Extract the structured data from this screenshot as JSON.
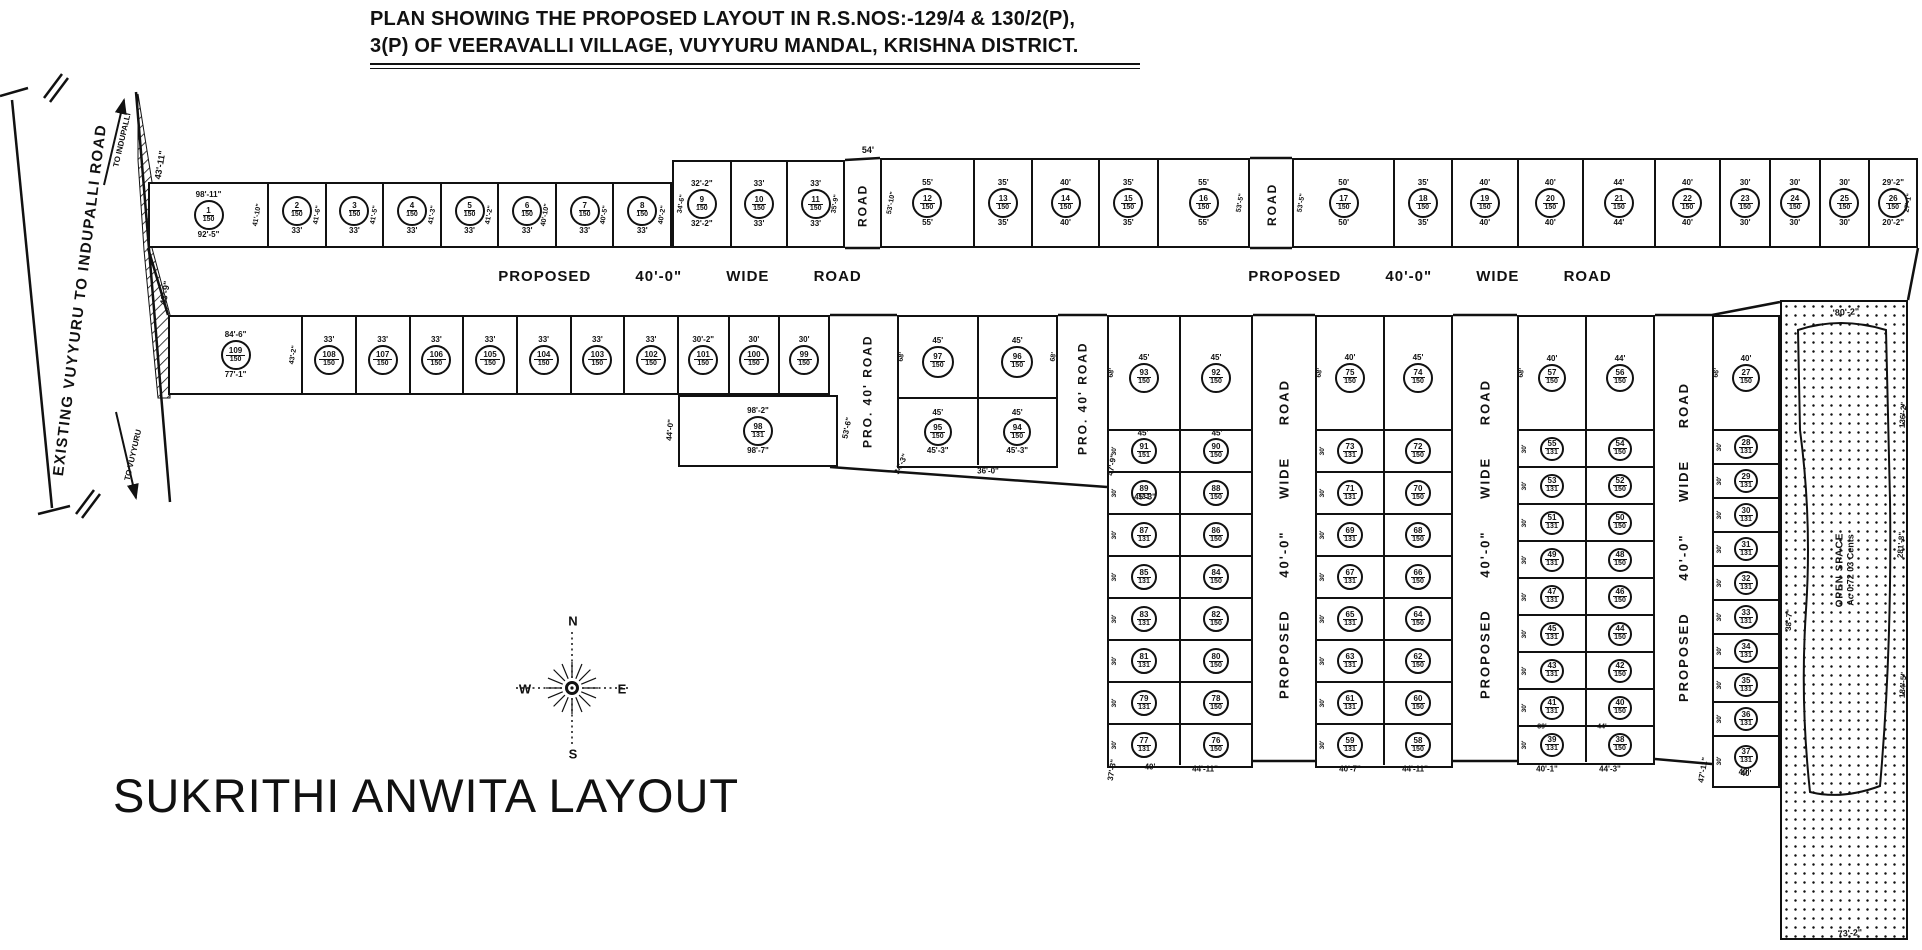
{
  "title": {
    "line1": "PLAN SHOWING THE PROPOSED LAYOUT IN R.S.NOS:-129/4 & 130/2(P),",
    "line2": "3(P) OF VEERAVALLI VILLAGE, VUYYURU MANDAL, KRISHNA DISTRICT."
  },
  "layout_name": "SUKRITHI ANWITA LAYOUT",
  "compass": {
    "n": "N",
    "s": "S",
    "e": "E",
    "w": "W"
  },
  "existing_road": {
    "name": "EXISTING VUYYURU TO INDUPALLI ROAD",
    "to_top": "TO INDUPALLI",
    "to_bottom": "TO VUYYURU"
  },
  "open_space": {
    "line1": "OPEN SPACE",
    "line2": "Ac 0.72 03 Cents"
  },
  "roads": {
    "horizontal": "PROPOSED 40'-0\" WIDE ROAD"
  },
  "strips": [
    {
      "id": "top-left",
      "x": 148,
      "y": 182,
      "w": 524,
      "h": 66,
      "circ": 30,
      "plots": [
        {
          "n": "1",
          "a": "150",
          "t": "98'-11\"",
          "b": "92'-5\"",
          "w": 118,
          "sr": "41'-10\""
        },
        {
          "n": "2",
          "a": "150",
          "b": "33'",
          "w": 58,
          "sr": "41'-6\""
        },
        {
          "n": "3",
          "a": "150",
          "b": "33'",
          "w": 58,
          "sr": "41'-5\""
        },
        {
          "n": "4",
          "a": "150",
          "b": "33'",
          "w": 58,
          "sr": "41'-3\""
        },
        {
          "n": "5",
          "a": "150",
          "b": "33'",
          "w": 58,
          "sr": "41'-2\""
        },
        {
          "n": "6",
          "a": "150",
          "b": "33'",
          "w": 58,
          "sr": "40'-10\""
        },
        {
          "n": "7",
          "a": "150",
          "b": "33'",
          "w": 58,
          "sr": "40'-5\""
        },
        {
          "n": "8",
          "a": "150",
          "b": "33'",
          "w": 58,
          "sr": "40'-2\""
        }
      ]
    },
    {
      "id": "top-mid-a",
      "x": 672,
      "y": 160,
      "w": 173,
      "h": 88,
      "circ": 30,
      "plots": [
        {
          "n": "9",
          "a": "150",
          "t": "32'-2\"",
          "b": "32'-2\"",
          "w": 57,
          "sl": "34'-6\""
        },
        {
          "n": "10",
          "a": "150",
          "t": "33'",
          "b": "33'",
          "w": 58
        },
        {
          "n": "11",
          "a": "150",
          "t": "33'",
          "b": "33'",
          "w": 58,
          "sr": "35'-9\""
        }
      ]
    },
    {
      "id": "top-mid-b",
      "x": 880,
      "y": 158,
      "w": 370,
      "h": 90,
      "circ": 30,
      "plots": [
        {
          "n": "12",
          "a": "150",
          "t": "55'",
          "b": "55'",
          "w": 92,
          "sl": "53'-10\""
        },
        {
          "n": "13",
          "a": "150",
          "t": "35'",
          "b": "35'",
          "w": 59
        },
        {
          "n": "14",
          "a": "150",
          "t": "40'",
          "b": "40'",
          "w": 67
        },
        {
          "n": "15",
          "a": "150",
          "t": "35'",
          "b": "35'",
          "w": 60
        },
        {
          "n": "16",
          "a": "150",
          "t": "55'",
          "b": "55'",
          "w": 92,
          "sr": "53'-5\""
        }
      ]
    },
    {
      "id": "top-right",
      "x": 1292,
      "y": 158,
      "w": 626,
      "h": 90,
      "circ": 30,
      "plots": [
        {
          "n": "17",
          "a": "150",
          "t": "50'",
          "b": "50'",
          "w": 100,
          "sl": "53'-5\""
        },
        {
          "n": "18",
          "a": "150",
          "t": "35'",
          "b": "35'",
          "w": 58
        },
        {
          "n": "19",
          "a": "150",
          "t": "40'",
          "b": "40'",
          "w": 66
        },
        {
          "n": "20",
          "a": "150",
          "t": "40'",
          "b": "40'",
          "w": 66
        },
        {
          "n": "21",
          "a": "150",
          "t": "44'",
          "b": "44'",
          "w": 72
        },
        {
          "n": "22",
          "a": "150",
          "t": "40'",
          "b": "40'",
          "w": 66
        },
        {
          "n": "23",
          "a": "150",
          "t": "30'",
          "b": "30'",
          "w": 50
        },
        {
          "n": "24",
          "a": "150",
          "t": "30'",
          "b": "30'",
          "w": 50
        },
        {
          "n": "25",
          "a": "150",
          "t": "30'",
          "b": "30'",
          "w": 50
        },
        {
          "n": "26",
          "a": "150",
          "t": "29'-2\"",
          "b": "20'-2\"",
          "w": 48,
          "sr": "27'-1\""
        }
      ]
    },
    {
      "id": "second-left",
      "x": 168,
      "y": 315,
      "w": 662,
      "h": 80,
      "circ": 30,
      "plots": [
        {
          "n": "109",
          "a": "150",
          "t": "84'-6\"",
          "b": "77'-1\"",
          "w": 132,
          "sr": "43'-2\""
        },
        {
          "n": "108",
          "a": "150",
          "t": "33'",
          "w": 54
        },
        {
          "n": "107",
          "a": "150",
          "t": "33'",
          "w": 54
        },
        {
          "n": "106",
          "a": "150",
          "t": "33'",
          "w": 54
        },
        {
          "n": "105",
          "a": "150",
          "t": "33'",
          "w": 54
        },
        {
          "n": "104",
          "a": "150",
          "t": "33'",
          "w": 54
        },
        {
          "n": "103",
          "a": "150",
          "t": "33'",
          "w": 54
        },
        {
          "n": "102",
          "a": "150",
          "t": "33'",
          "w": 54
        },
        {
          "n": "101",
          "a": "150",
          "t": "30'-2\"",
          "w": 51
        },
        {
          "n": "100",
          "a": "150",
          "t": "30'",
          "w": 51
        },
        {
          "n": "99",
          "a": "150",
          "t": "30'",
          "w": 50
        }
      ]
    },
    {
      "id": "plot-98-block",
      "x": 678,
      "y": 395,
      "w": 160,
      "h": 72,
      "circ": 30,
      "plots": [
        {
          "n": "98",
          "a": "131",
          "t": "98'-2\"",
          "b": "98'-7\""
        }
      ]
    }
  ],
  "groups": [
    {
      "id": "block-f",
      "x": 897,
      "y": 315,
      "w": 161,
      "topH": 80,
      "rowH": 68,
      "circ": 28,
      "top": [
        {
          "n": "97",
          "a": "150",
          "t": "45'",
          "sl": "68'"
        },
        {
          "n": "96",
          "a": "150",
          "t": "45'",
          "sr": "68'"
        }
      ],
      "rows": [
        {
          "cells": [
            {
              "n": "95",
              "a": "150",
              "t": "45'",
              "b": "45'-3\""
            },
            {
              "n": "94",
              "a": "150",
              "t": "45'",
              "b": "45'-3\""
            }
          ]
        }
      ]
    },
    {
      "id": "g1",
      "x": 1107,
      "y": 315,
      "w": 146,
      "topH": 112,
      "rowH": 42,
      "circ": 26,
      "row_side": "30'",
      "top": [
        {
          "n": "93",
          "a": "150",
          "t": "45'",
          "sl": "68'"
        },
        {
          "n": "92",
          "a": "150",
          "t": "45'"
        }
      ],
      "rows": [
        {
          "cells": [
            {
              "n": "91",
              "a": "151"
            },
            {
              "n": "90",
              "a": "150"
            }
          ]
        },
        {
          "cells": [
            {
              "n": "89",
              "a": "131"
            },
            {
              "n": "88",
              "a": "150"
            }
          ]
        },
        {
          "cells": [
            {
              "n": "87",
              "a": "131"
            },
            {
              "n": "86",
              "a": "150"
            }
          ]
        },
        {
          "cells": [
            {
              "n": "85",
              "a": "131"
            },
            {
              "n": "84",
              "a": "150"
            }
          ]
        },
        {
          "cells": [
            {
              "n": "83",
              "a": "131"
            },
            {
              "n": "82",
              "a": "150"
            }
          ]
        },
        {
          "cells": [
            {
              "n": "81",
              "a": "131"
            },
            {
              "n": "80",
              "a": "150"
            }
          ]
        },
        {
          "cells": [
            {
              "n": "79",
              "a": "131"
            },
            {
              "n": "78",
              "a": "150"
            }
          ]
        },
        {
          "cells": [
            {
              "n": "77",
              "a": "131"
            },
            {
              "n": "76",
              "a": "150"
            }
          ]
        }
      ]
    },
    {
      "id": "g2",
      "x": 1315,
      "y": 315,
      "w": 138,
      "topH": 112,
      "rowH": 42,
      "circ": 26,
      "row_side": "30'",
      "top": [
        {
          "n": "75",
          "a": "150",
          "t": "40'",
          "sl": "68'"
        },
        {
          "n": "74",
          "a": "150",
          "t": "45'"
        }
      ],
      "rows": [
        {
          "cells": [
            {
              "n": "73",
              "a": "131"
            },
            {
              "n": "72",
              "a": "150"
            }
          ]
        },
        {
          "cells": [
            {
              "n": "71",
              "a": "131"
            },
            {
              "n": "70",
              "a": "150"
            }
          ]
        },
        {
          "cells": [
            {
              "n": "69",
              "a": "131"
            },
            {
              "n": "68",
              "a": "150"
            }
          ]
        },
        {
          "cells": [
            {
              "n": "67",
              "a": "131"
            },
            {
              "n": "66",
              "a": "150"
            }
          ]
        },
        {
          "cells": [
            {
              "n": "65",
              "a": "131"
            },
            {
              "n": "64",
              "a": "150"
            }
          ]
        },
        {
          "cells": [
            {
              "n": "63",
              "a": "131"
            },
            {
              "n": "62",
              "a": "150"
            }
          ]
        },
        {
          "cells": [
            {
              "n": "61",
              "a": "131"
            },
            {
              "n": "60",
              "a": "150"
            }
          ]
        },
        {
          "cells": [
            {
              "n": "59",
              "a": "131"
            },
            {
              "n": "58",
              "a": "150"
            }
          ]
        }
      ]
    },
    {
      "id": "g3",
      "x": 1517,
      "y": 315,
      "w": 138,
      "topH": 112,
      "rowH": 37,
      "circ": 24,
      "row_side": "30'",
      "top": [
        {
          "n": "57",
          "a": "150",
          "t": "40'",
          "sl": "68'"
        },
        {
          "n": "56",
          "a": "150",
          "t": "44'"
        }
      ],
      "rows": [
        {
          "cells": [
            {
              "n": "55",
              "a": "131"
            },
            {
              "n": "54",
              "a": "150"
            }
          ]
        },
        {
          "cells": [
            {
              "n": "53",
              "a": "131"
            },
            {
              "n": "52",
              "a": "150"
            }
          ]
        },
        {
          "cells": [
            {
              "n": "51",
              "a": "131"
            },
            {
              "n": "50",
              "a": "150"
            }
          ]
        },
        {
          "cells": [
            {
              "n": "49",
              "a": "131"
            },
            {
              "n": "48",
              "a": "150"
            }
          ]
        },
        {
          "cells": [
            {
              "n": "47",
              "a": "131"
            },
            {
              "n": "46",
              "a": "150"
            }
          ]
        },
        {
          "cells": [
            {
              "n": "45",
              "a": "131"
            },
            {
              "n": "44",
              "a": "150"
            }
          ]
        },
        {
          "cells": [
            {
              "n": "43",
              "a": "131"
            },
            {
              "n": "42",
              "a": "150"
            }
          ]
        },
        {
          "cells": [
            {
              "n": "41",
              "a": "131"
            },
            {
              "n": "40",
              "a": "150"
            }
          ]
        },
        {
          "cells": [
            {
              "n": "39",
              "a": "131"
            },
            {
              "n": "38",
              "a": "150"
            }
          ]
        }
      ]
    },
    {
      "id": "g4",
      "x": 1712,
      "y": 315,
      "w": 68,
      "topH": 112,
      "rowH": 34,
      "circ": 24,
      "row_side": "30'",
      "top": [
        {
          "n": "27",
          "a": "150",
          "t": "40'",
          "sl": "66'"
        }
      ],
      "rows": [
        {
          "cells": [
            {
              "n": "28",
              "a": "131"
            }
          ]
        },
        {
          "cells": [
            {
              "n": "29",
              "a": "131"
            }
          ]
        },
        {
          "cells": [
            {
              "n": "30",
              "a": "131"
            }
          ]
        },
        {
          "cells": [
            {
              "n": "31",
              "a": "131"
            }
          ]
        },
        {
          "cells": [
            {
              "n": "32",
              "a": "131"
            }
          ]
        },
        {
          "cells": [
            {
              "n": "33",
              "a": "131"
            }
          ]
        },
        {
          "cells": [
            {
              "n": "34",
              "a": "131"
            }
          ]
        },
        {
          "cells": [
            {
              "n": "35",
              "a": "131"
            }
          ]
        },
        {
          "cells": [
            {
              "n": "36",
              "a": "131"
            }
          ]
        },
        {
          "h": 50,
          "cells": [
            {
              "n": "37",
              "a": "131",
              "b": "40'"
            }
          ]
        }
      ]
    }
  ],
  "vroads": [
    {
      "x": 845,
      "y": 162,
      "h": 86,
      "w": 35,
      "label": "ROAD",
      "fs": 12
    },
    {
      "x": 1252,
      "y": 160,
      "h": 88,
      "w": 40,
      "label": "ROAD",
      "fs": 12
    },
    {
      "x": 838,
      "y": 317,
      "h": 148,
      "w": 59,
      "label": "PRO. 40' ROAD",
      "fs": 12
    },
    {
      "x": 1058,
      "y": 317,
      "h": 163,
      "w": 49,
      "label": "PRO. 40' ROAD",
      "fs": 12
    },
    {
      "x": 1253,
      "y": 317,
      "h": 444,
      "w": 62,
      "label": "PROPOSED 40'-0\" WIDE ROAD",
      "fs": 13,
      "ws": 26
    },
    {
      "x": 1453,
      "y": 317,
      "h": 444,
      "w": 64,
      "label": "PROPOSED 40'-0\" WIDE ROAD",
      "fs": 13,
      "ws": 26
    },
    {
      "x": 1655,
      "y": 317,
      "h": 450,
      "w": 57,
      "label": "PROPOSED 40'-0\" WIDE ROAD",
      "fs": 13,
      "ws": 26
    }
  ],
  "annotations": [
    {
      "t": "43'-11\"",
      "x": 160,
      "y": 165,
      "r": -80,
      "s": 9
    },
    {
      "t": "43'-9\"",
      "x": 165,
      "y": 293,
      "r": -80,
      "s": 9
    },
    {
      "t": "54'",
      "x": 868,
      "y": 150,
      "r": 0,
      "s": 9
    },
    {
      "t": "44'-0\"",
      "x": 670,
      "y": 430,
      "r": -85,
      "s": 8
    },
    {
      "t": "53'-6\"",
      "x": 847,
      "y": 428,
      "r": -78,
      "s": 8
    },
    {
      "t": "34'-3\"",
      "x": 901,
      "y": 464,
      "r": -65,
      "s": 8
    },
    {
      "t": "36'-0\"",
      "x": 988,
      "y": 471,
      "r": 0,
      "s": 8
    },
    {
      "t": "45'",
      "x": 1143,
      "y": 433,
      "r": 0,
      "s": 8
    },
    {
      "t": "45'",
      "x": 1217,
      "y": 433,
      "r": 0,
      "s": 8
    },
    {
      "t": "45'-3\"",
      "x": 1145,
      "y": 497,
      "r": 0,
      "s": 8
    },
    {
      "t": "47'-9\"",
      "x": 1112,
      "y": 465,
      "r": -80,
      "s": 8
    },
    {
      "t": "37'-3\"",
      "x": 1112,
      "y": 770,
      "r": -80,
      "s": 8
    },
    {
      "t": "40'",
      "x": 1150,
      "y": 767,
      "r": 0,
      "s": 8
    },
    {
      "t": "44'-11\"",
      "x": 1205,
      "y": 769,
      "r": 0,
      "s": 8
    },
    {
      "t": "40'-7\"",
      "x": 1350,
      "y": 769,
      "r": 0,
      "s": 8
    },
    {
      "t": "44'-11\"",
      "x": 1415,
      "y": 769,
      "r": 0,
      "s": 8
    },
    {
      "t": "39'",
      "x": 1542,
      "y": 727,
      "r": 0,
      "s": 7
    },
    {
      "t": "44'",
      "x": 1602,
      "y": 727,
      "r": 0,
      "s": 7
    },
    {
      "t": "40'-1\"",
      "x": 1547,
      "y": 769,
      "r": 0,
      "s": 8
    },
    {
      "t": "44'-3\"",
      "x": 1610,
      "y": 769,
      "r": 0,
      "s": 8
    },
    {
      "t": "47'-11\"",
      "x": 1703,
      "y": 770,
      "r": -80,
      "s": 8
    },
    {
      "t": "40'",
      "x": 1744,
      "y": 772,
      "r": 0,
      "s": 8
    },
    {
      "t": "'80'-2\"",
      "x": 1846,
      "y": 312,
      "r": -3,
      "s": 9
    },
    {
      "t": "136'-2\"",
      "x": 1903,
      "y": 415,
      "r": -86,
      "s": 8
    },
    {
      "t": "281'-8\"",
      "x": 1901,
      "y": 545,
      "r": -86,
      "s": 8
    },
    {
      "t": "184'-5\"",
      "x": 1903,
      "y": 685,
      "r": -86,
      "s": 8
    },
    {
      "t": "38'-7\"",
      "x": 1789,
      "y": 620,
      "r": -86,
      "s": 8
    },
    {
      "t": "73'-2\"",
      "x": 1850,
      "y": 933,
      "r": -4,
      "s": 9
    }
  ]
}
